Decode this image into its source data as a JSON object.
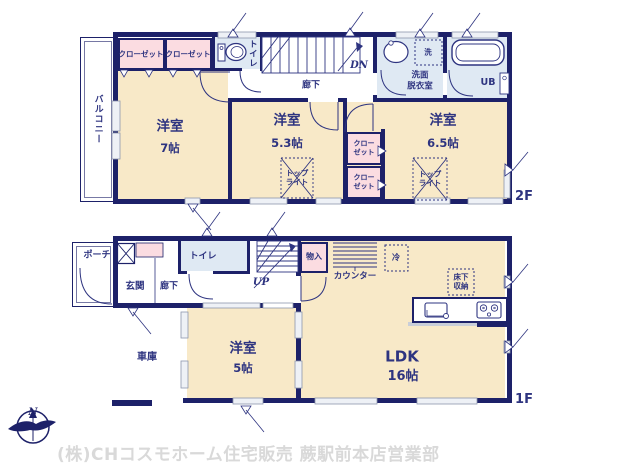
{
  "colors": {
    "wall": "#1d2169",
    "text": "#2e3480",
    "room_cream": "#f8e9c8",
    "closet_pink": "#fbdce1",
    "wet_area_blue": "#dfe9f3",
    "window_gray": "#8d97ad",
    "watermark_gray": "#d9d9d9"
  },
  "floor2": {
    "tag": "2F",
    "balcony": "バルコニー",
    "closet_left": "クローゼット",
    "closet_right": "クローゼット",
    "toilet": "トイレ",
    "stairs_dn": "DN",
    "hallway": "廊下",
    "washroom": "洗面\n脱衣室",
    "laundry": "洗",
    "bath": "UB",
    "room_a": {
      "name": "洋室",
      "size": "7帖"
    },
    "room_b": {
      "name": "洋室",
      "size": "5.3帖"
    },
    "room_c": {
      "name": "洋室",
      "size": "6.5帖"
    },
    "closet_mid_top": "クロー\nゼット",
    "closet_mid_bottom": "クロー\nゼット",
    "skylight_b": "トップ\nライト",
    "skylight_c": "トップ\nライト"
  },
  "floor1": {
    "tag": "1F",
    "porch": "ポーチ",
    "entrance": "玄関",
    "hallway": "廊下",
    "toilet": "トイレ",
    "stairs_up": "UP",
    "storage": "物入",
    "counter": "カウンター",
    "refrigerator": "冷",
    "underfloor_storage": "床下\n収納",
    "ldk": {
      "name": "LDK",
      "size": "16帖"
    },
    "room_d": {
      "name": "洋室",
      "size": "5帖"
    },
    "garage": "車庫"
  },
  "compass_north": "N",
  "watermark": "(株)CHコスモホーム住宅販売 蕨駅前本店営業部"
}
